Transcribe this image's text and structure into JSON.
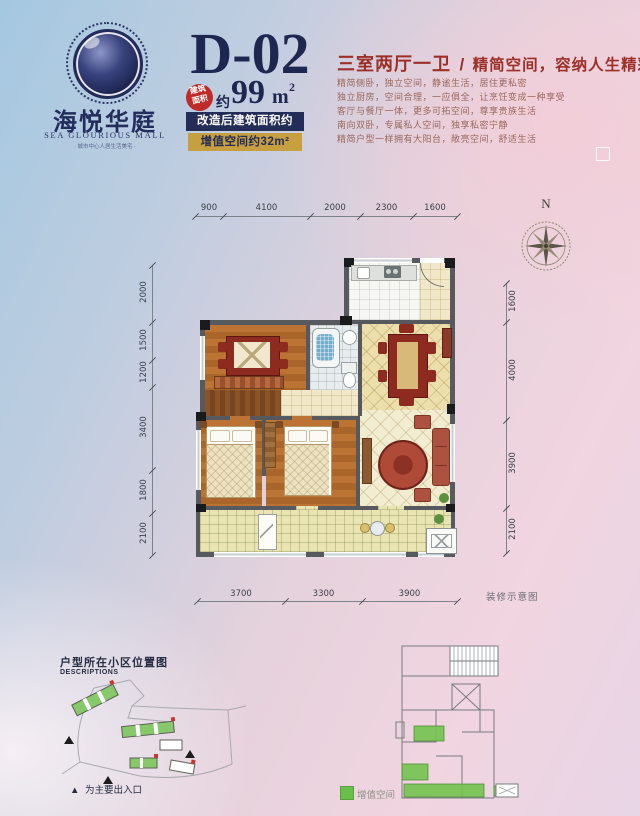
{
  "logo": {
    "name_cn": "海悦华庭",
    "name_en": "SEA GLOURIOUS MALL",
    "tagline": "· 城市中心人居生活美宅 ·"
  },
  "header": {
    "unit_code": "D-02",
    "badge_line1": "建筑",
    "badge_line2": "面积",
    "area_prefix": "约",
    "area_value": "99",
    "area_unit": "m",
    "area_sup": "2",
    "bar1": "改造后建筑面积约131m²",
    "bar2": "增值空间约32m²"
  },
  "intro": {
    "title": "三室两厅一卫",
    "separator": "/",
    "subtitle": "精简空间，容纳人生精彩",
    "lines": [
      "精简侧卧，独立空间，静谧生活，居住更私密",
      "独立厨房，空间合理，一应俱全，让烹饪变成一种享受",
      "客厅与餐厅一体，更多可拓空间，尊享贵族生活",
      "南向双卧，专属私人空间，独享私密宁静",
      "精简户型一样拥有大阳台，敞亮空间，舒适生活"
    ]
  },
  "plan": {
    "compass_label": "N",
    "note": "装修示意图",
    "dims_top": [
      "900",
      "4100",
      "2000",
      "2300",
      "1600"
    ],
    "dims_left": [
      "2000",
      "1500",
      "1200",
      "3400",
      "1800",
      "2100"
    ],
    "dims_right": [
      "1600",
      "4000",
      "3900",
      "2100"
    ],
    "dims_bottom": [
      "3700",
      "3300",
      "3900"
    ]
  },
  "sitemap": {
    "title": "户型所在小区位置图",
    "subtitle": "DESCRIPTIONS",
    "note_marker": "▲",
    "note_text": "为主要出入口"
  },
  "keyplan": {
    "legend_label": "增值空间",
    "legend_color": "#6abf4b"
  }
}
